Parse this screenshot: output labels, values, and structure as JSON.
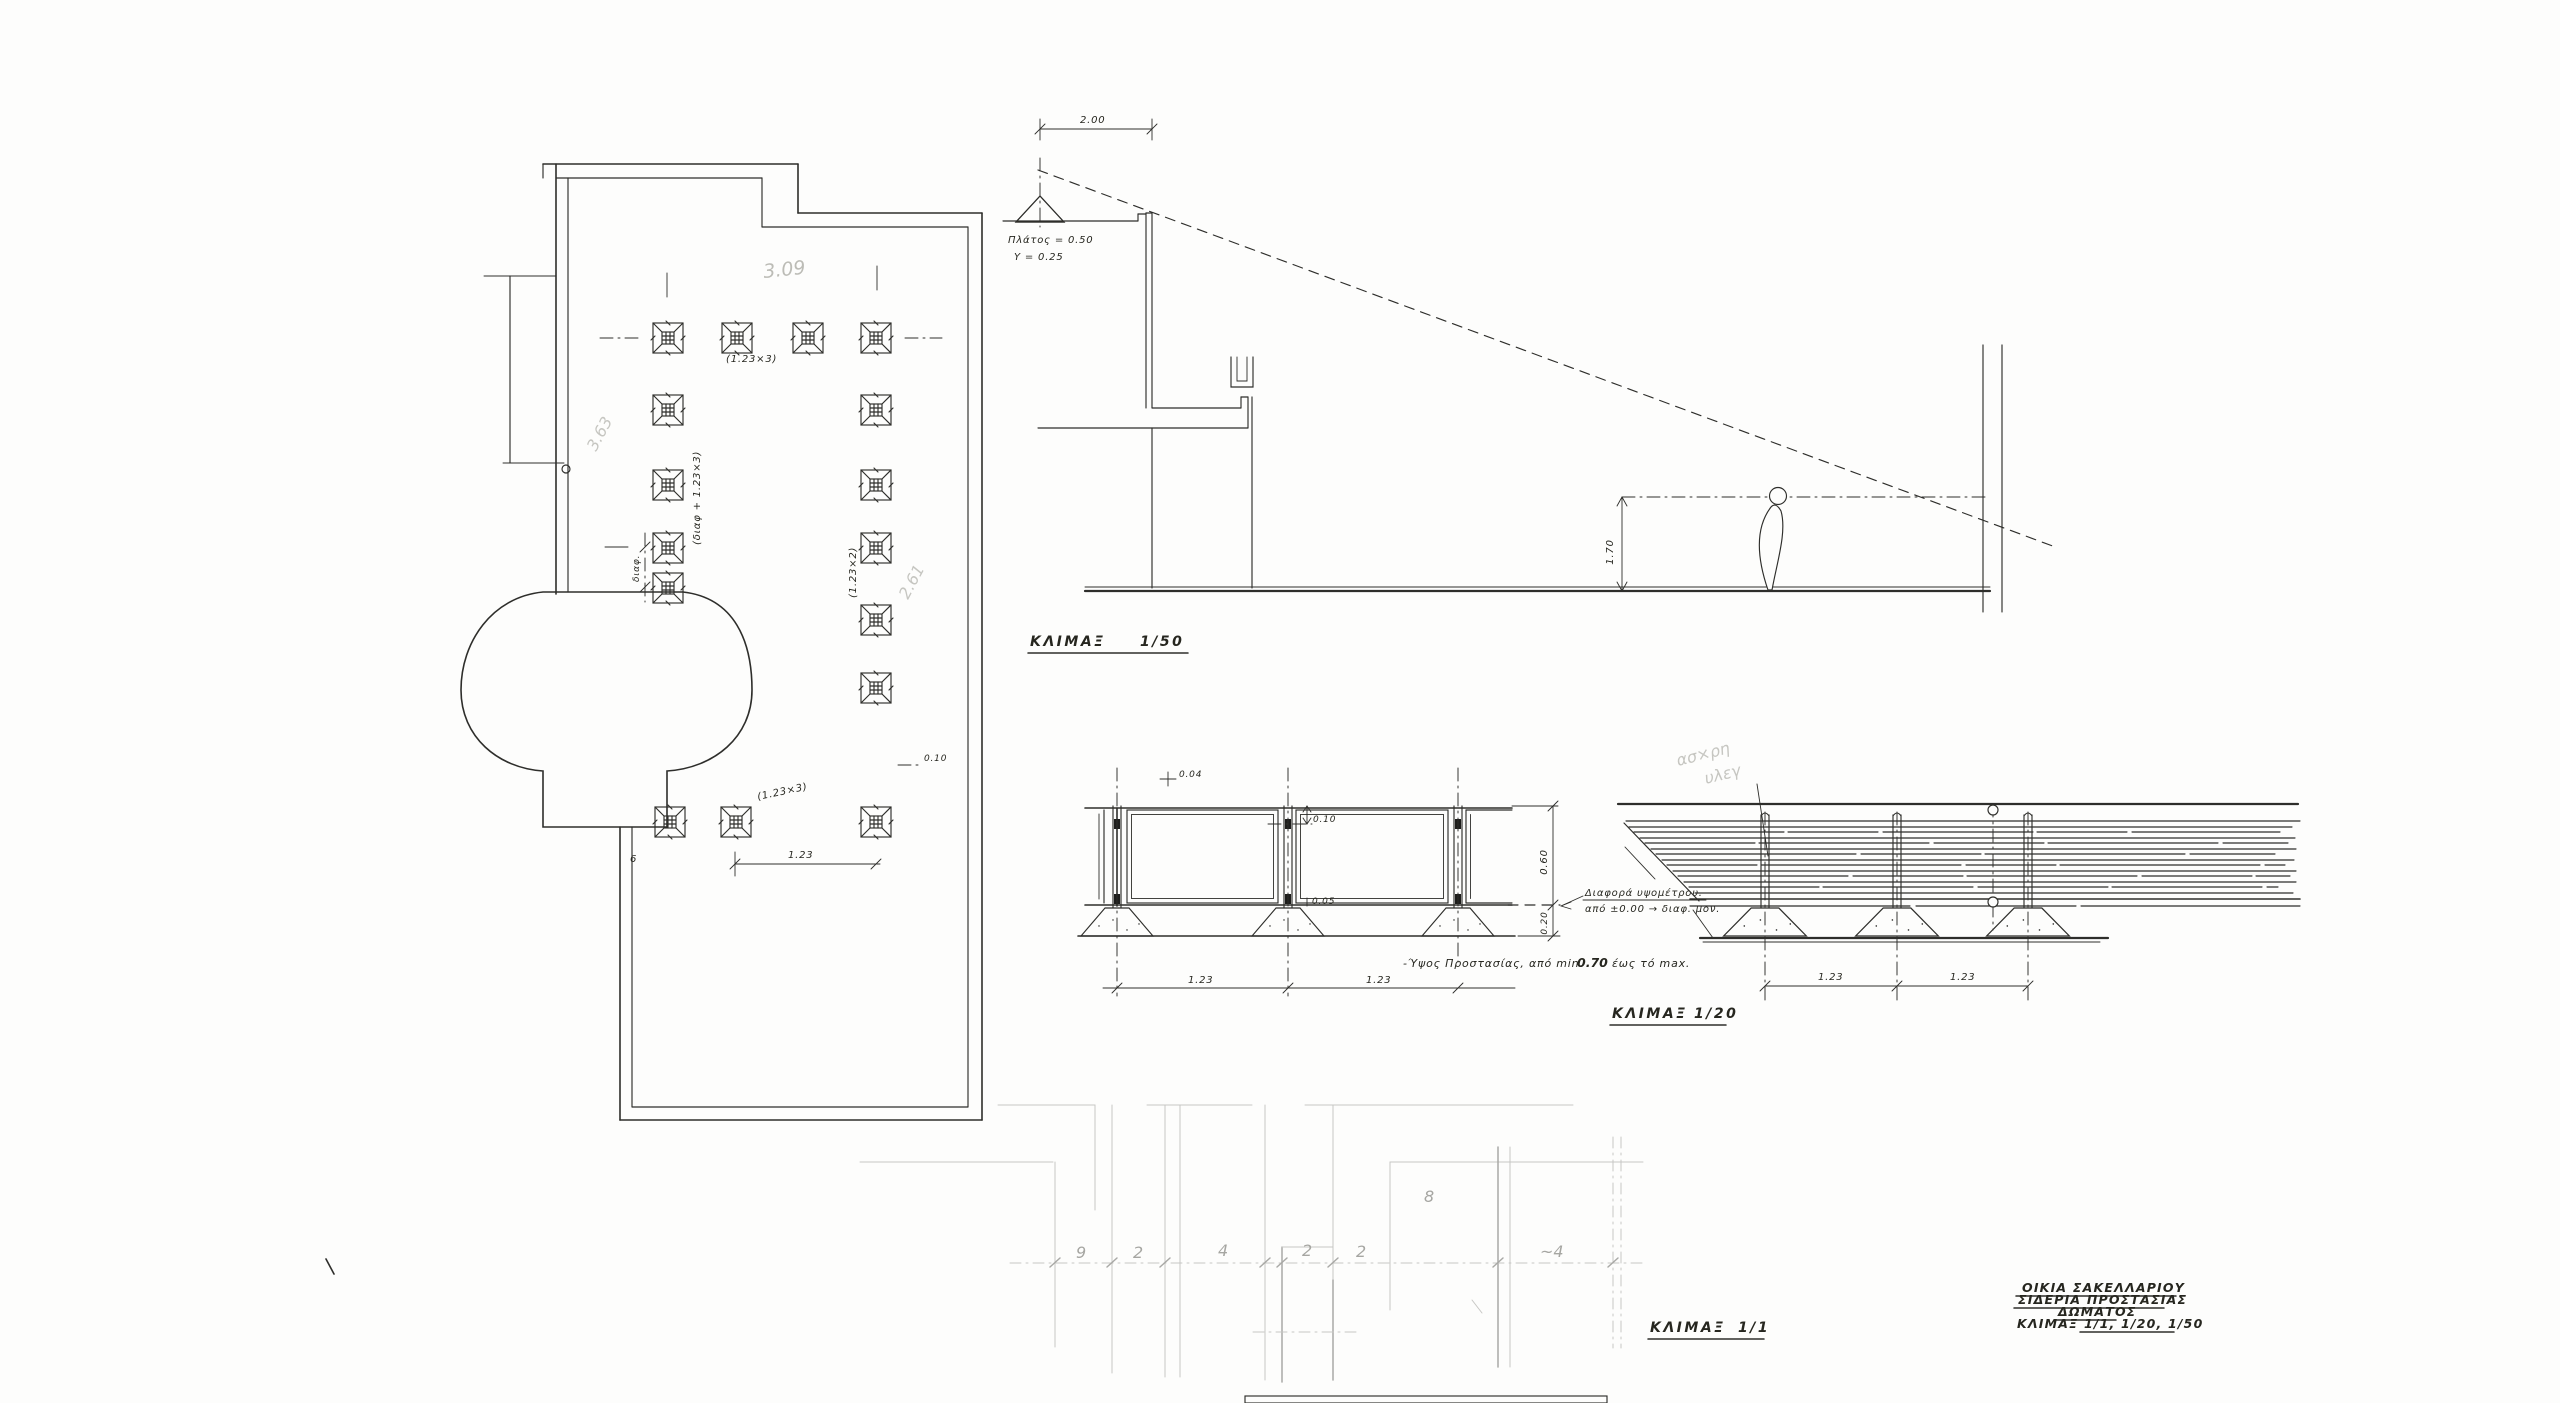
{
  "colors": {
    "ink": "#2e2e2b",
    "pencil": "#bcbcb6",
    "faint": "#c7c7c4",
    "paper": "#fdfdfc"
  },
  "title_block": {
    "line1": "ΟΙΚΙΑ  ΣΑΚΕΛΛΑΡΙΟΥ",
    "line2": "ΣΙΔΕΡΙΑ ΠΡΟΣΤΑΣΙΑΣ",
    "line3": "ΔΩΜΑΤΟΣ",
    "line4_label": "ΚΛΙΜΑΞ",
    "line4_scales": "1/1, 1/20, 1/50"
  },
  "scales": {
    "s50_label": "ΚΛΙΜΑΞ",
    "s50_value": "1/50",
    "s20_label": "ΚΛΙΜΑΞ",
    "s20_value": "1/20",
    "s1_label": "ΚΛΙΜΑΞ",
    "s1_value": "1/1"
  },
  "plan": {
    "ann_bay_top": "(1.23×3)",
    "ann_bay_left": "(διαφ + 1.23×3)",
    "ann_diff": "διαφ.",
    "ann_bay_right": "(1.23×2)",
    "ann_bay_bottom": "(1.23×3)",
    "dim_bottom": "1.23",
    "ann_offset": "0.10",
    "leg_mark": "6",
    "pencil_top": "3.09",
    "pencil_left": "3.63",
    "pencil_right": "2.61"
  },
  "section": {
    "dim_width": "2.00",
    "note1": "Πλάτος = 0.50",
    "note2": "Υ = 0.25",
    "dim_eye": "1.70"
  },
  "railing": {
    "dim_cap": "0.04",
    "dim_gap_top": "0.10",
    "dim_gap_bottom": "0.05",
    "bay1": "1.23",
    "bay2": "1.23",
    "h_upper": "0.60",
    "h_lower": "0.20",
    "leader1": "Διαφορά υψομέτρου.",
    "leader2": "από ±0.00 → διαφ. μον.",
    "note_prefix": "-Ύψος Προστασίας, από min",
    "note_value": "0.70",
    "note_suffix": "έως τό max.",
    "plan_bay1": "1.23",
    "plan_bay2": "1.23",
    "pencil1": "ασ×ρη",
    "pencil2": "υλεγ"
  },
  "detail": {
    "dims": [
      "9",
      "2",
      "4",
      "2",
      "2",
      "~4"
    ],
    "note8": "8"
  }
}
